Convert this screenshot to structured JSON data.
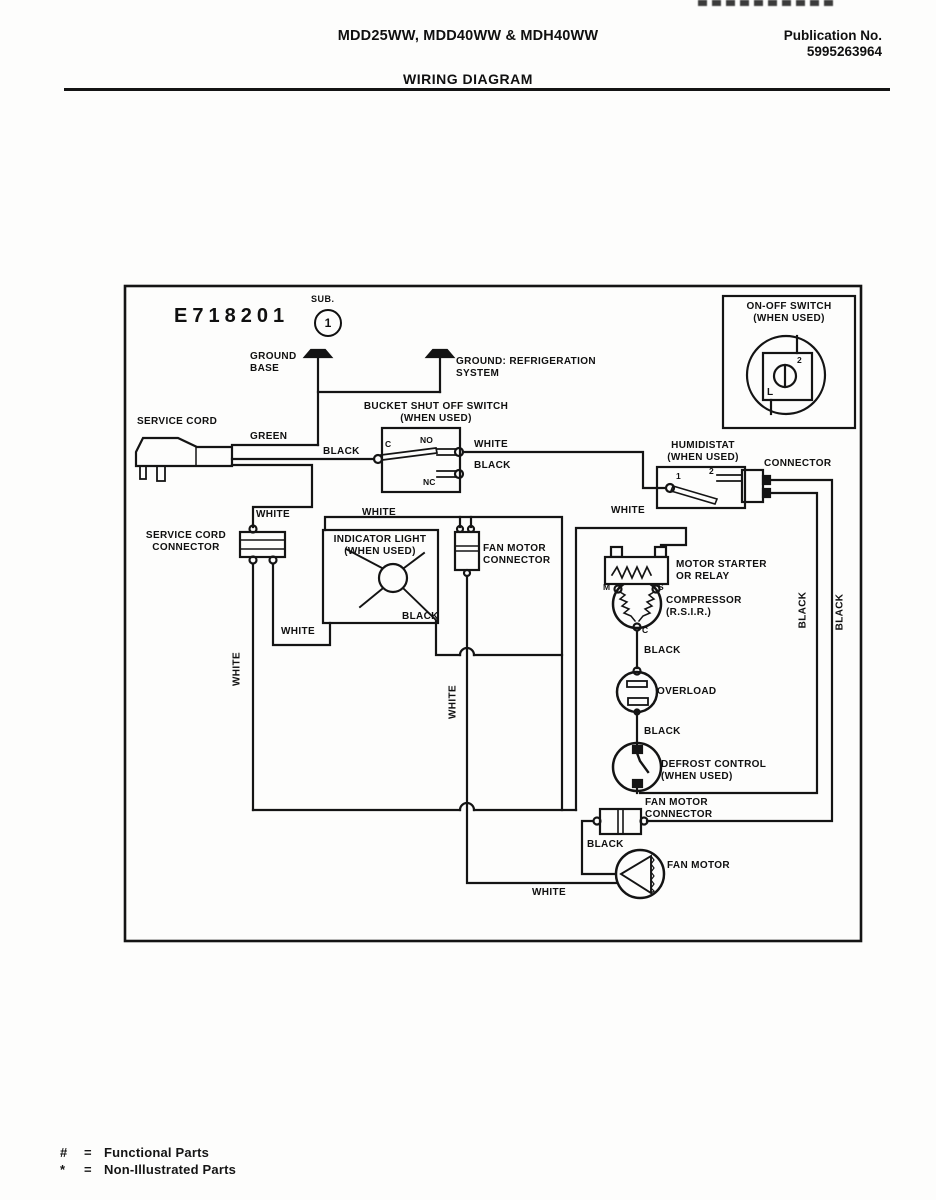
{
  "header": {
    "models": "MDD25WW, MDD40WW & MDH40WW",
    "publication": "Publication No.\n5995263964",
    "title": "WIRING DIAGRAM"
  },
  "diagram": {
    "drawing_number": "E718201",
    "sub": {
      "label": "SUB.",
      "number": "1"
    },
    "labels": {
      "on_off_switch": "ON-OFF SWITCH\n(WHEN USED)",
      "on_off_terminal_2": "2",
      "on_off_terminal_l": "L",
      "ground_base": "GROUND\nBASE",
      "ground_refrigeration": "GROUND: REFRIGERATION\nSYSTEM",
      "service_cord": "SERVICE CORD",
      "green": "GREEN",
      "black_cord": "BLACK",
      "bucket_switch": "BUCKET SHUT OFF SWITCH\n(WHEN USED)",
      "terminal_c": "C",
      "terminal_no": "NO",
      "terminal_nc": "NC",
      "white_no": "WHITE",
      "black_nc": "BLACK",
      "humidistat": "HUMIDISTAT\n(WHEN USED)",
      "humidistat_terminal_1": "1",
      "humidistat_terminal_2": "2",
      "connector": "CONNECTOR",
      "white_drop": "WHITE",
      "service_cord_connector": "SERVICE CORD\nCONNECTOR",
      "white_bus": "WHITE",
      "white_starter": "WHITE",
      "indicator_light": "INDICATOR LIGHT\n(WHEN USED)",
      "black_lamp": "BLACK",
      "fan_motor_connector_upper": "FAN MOTOR\nCONNECTOR",
      "white_left_vertical": "WHITE",
      "white_mid_link": "WHITE",
      "white_center_vertical": "WHITE",
      "motor_starter": "MOTOR STARTER\nOR RELAY",
      "compressor": "COMPRESSOR\n(R.S.I.R.)",
      "terminal_m": "M",
      "terminal_s": "S",
      "terminal_comp_c": "C",
      "black_compressor": "BLACK",
      "overload": "OVERLOAD",
      "black_overload": "BLACK",
      "defrost_control": "DEFROST CONTROL\n(WHEN USED)",
      "fan_motor_connector_lower": "FAN MOTOR\nCONNECTOR",
      "black_fan": "BLACK",
      "fan_motor": "FAN MOTOR",
      "white_bottom": "WHITE",
      "black_right_inner": "BLACK",
      "black_right_outer": "BLACK"
    }
  },
  "footer": {
    "functional_symbol": "#",
    "functional_eq": "=",
    "functional_text": "Functional Parts",
    "non_illustrated_symbol": "*",
    "non_illustrated_eq": "=",
    "non_illustrated_text": "Non-Illustrated Parts"
  },
  "colors": {
    "ink": "#101010",
    "paper": "#fdfdfc"
  }
}
